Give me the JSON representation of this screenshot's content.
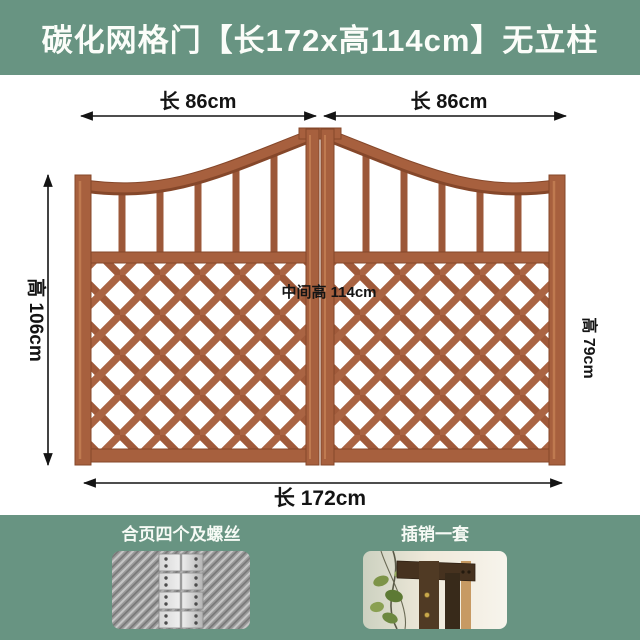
{
  "header": {
    "title": "碳化网格门【长172x高114cm】无立柱"
  },
  "diagram": {
    "dim_top_left": "长 86cm",
    "dim_top_right": "长 86cm",
    "dim_left": "高 106cm",
    "dim_center": "中间高 114cm",
    "dim_right": "高 79cm",
    "dim_bottom": "长 172cm"
  },
  "colors": {
    "banner_green": "#689482",
    "wood": "#a7603e",
    "dimension_text": "#141414"
  },
  "footer": {
    "cards": [
      {
        "label": "合页四个及螺丝",
        "photo": "hinges-photo"
      },
      {
        "label": "插销一套",
        "photo": "latch-photo"
      }
    ]
  }
}
